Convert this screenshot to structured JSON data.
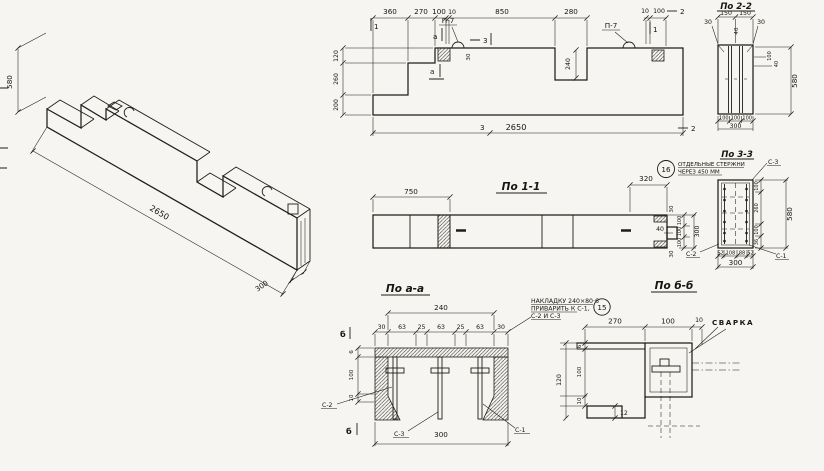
{
  "iso": {
    "height": "580",
    "length": "2650",
    "width": "300"
  },
  "elev": {
    "top_dims": [
      "360",
      "270",
      "100",
      "10",
      "850",
      "280"
    ],
    "right_dims": [
      "10",
      "100"
    ],
    "left_dims": [
      "120",
      "260",
      "200"
    ],
    "total": "2650",
    "notch": "240",
    "loop_h": "30",
    "loop": "П-7",
    "mark1": "1",
    "mark2": "2",
    "mark3": "3",
    "marka": "а"
  },
  "s22": {
    "title": "По 2-2",
    "top": [
      "150",
      "150"
    ],
    "side": [
      "30",
      "30"
    ],
    "groove": "40",
    "right": [
      "100",
      "40"
    ],
    "height": "580",
    "bottom": [
      "100",
      "100",
      "100"
    ],
    "width": "300"
  },
  "s11": {
    "title": "По 1-1",
    "d750": "750",
    "d320": "320",
    "end": [
      "30",
      "40",
      "30"
    ],
    "wchain": [
      "100",
      "100",
      "100"
    ],
    "wtotal": "300",
    "c2": "С-2"
  },
  "n16": {
    "num": "16",
    "l1": "ОТДЕЛЬНЫЕ СТЕРЖНИ",
    "l2": "ЧЕРЕЗ 450 ММ"
  },
  "s33": {
    "title": "По 3-3",
    "c3": "С-3",
    "c1": "С-1",
    "bottom": [
      "52",
      "108",
      "88",
      "52"
    ],
    "btotal": "300",
    "right": [
      "100",
      "260",
      "100",
      "36"
    ],
    "height": "580"
  },
  "saa": {
    "title": "По а-а",
    "width": "240",
    "chain": [
      "30",
      "63",
      "25",
      "63",
      "25",
      "63",
      "30"
    ],
    "left": [
      "6",
      "100",
      "10"
    ],
    "btotal": "300",
    "c1": "С-1",
    "c2": "С-2",
    "c3": "С-3",
    "markb": "б"
  },
  "n15": {
    "num": "15",
    "l1": "НАКЛАДКУ 240×80·6",
    "l2": "ПРИВАРИТЬ К С-1,",
    "l3": "С-2 И С-3"
  },
  "sbb": {
    "title": "По б-б",
    "top": [
      "270",
      "100",
      "10"
    ],
    "weld": "СВАРКА",
    "left": [
      "6",
      "100",
      "10"
    ],
    "total": "120",
    "gap": "12"
  }
}
